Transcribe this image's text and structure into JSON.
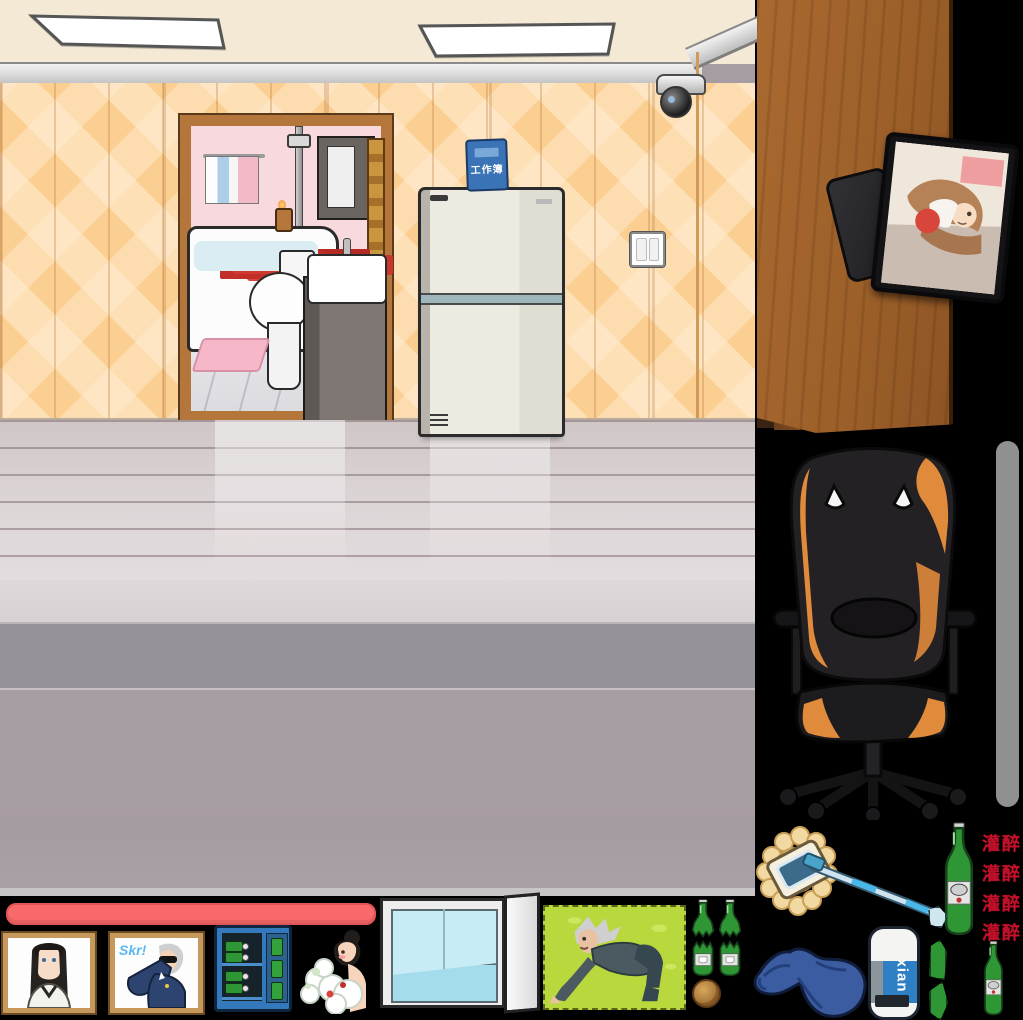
{
  "scene": {
    "type": "point-and-click room scene with item sprites",
    "room": {
      "workbook_sign": "工作簿",
      "colors": {
        "wallpaper": "#fbcf92",
        "ceiling": "#f3e9d5",
        "bathroom_wall": "#f8d9dd",
        "floor": "#d8d2d3",
        "foreground": "#a69da3"
      }
    }
  },
  "items": {
    "drunk_labels": [
      "灌醉",
      "灌醉",
      "灌醉",
      "灌醉"
    ],
    "drunk_color": "#c3112b",
    "graffiti_text": "Skr!",
    "eraser_brand": "xian",
    "colors": {
      "chair_accent": "#e8913f",
      "health_bar": "#f8696a",
      "scrollbar": "#909090",
      "bottle_green": "#2f9636",
      "door_wood": "#a2632c",
      "clothes_blue": "#3c5ca2",
      "picture_green": "#b8d83e"
    }
  }
}
